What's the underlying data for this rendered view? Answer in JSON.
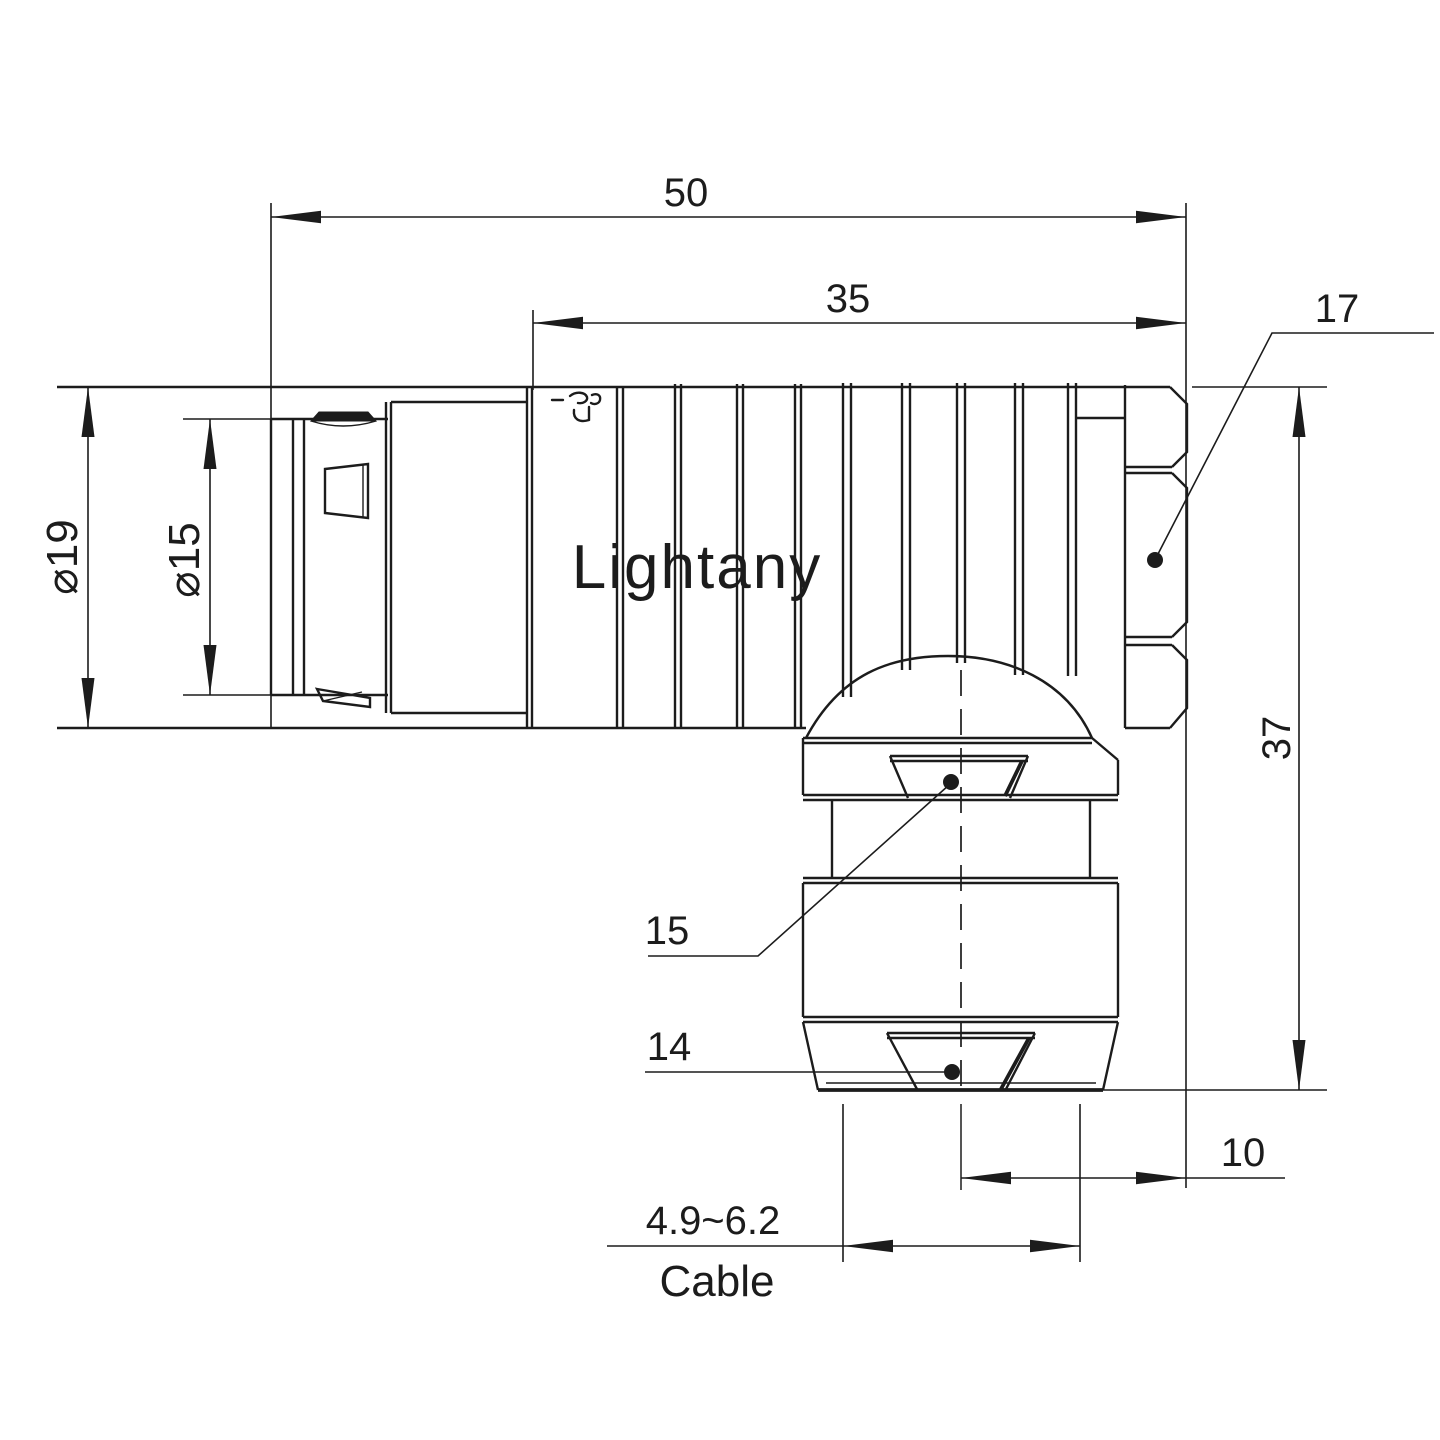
{
  "drawing": {
    "type": "technical-drawing",
    "subject": "right-angle push-pull circular connector, side elevation with section labels",
    "line_color": "#1c1c1c",
    "background_color": "#ffffff"
  },
  "watermark": {
    "text": "Lightany",
    "color": "#f8cbcb"
  },
  "dimensions": {
    "overall_length": {
      "value": "50",
      "orientation": "horizontal"
    },
    "body_length": {
      "value": "35",
      "orientation": "horizontal"
    },
    "hex_nut_label": {
      "value": "17",
      "orientation": "leader"
    },
    "outer_diameter": {
      "value": "⌀19",
      "orientation": "vertical"
    },
    "front_diameter": {
      "value": "⌀15",
      "orientation": "vertical"
    },
    "overall_height": {
      "value": "37",
      "orientation": "vertical"
    },
    "gland_upper_label": {
      "value": "15",
      "orientation": "leader"
    },
    "gland_lower_label": {
      "value": "14",
      "orientation": "leader"
    },
    "axis_to_end": {
      "value": "10",
      "orientation": "horizontal"
    },
    "cable_range": {
      "value": "4.9~6.2",
      "orientation": "horizontal"
    },
    "cable_word": {
      "value": "Cable",
      "orientation": "horizontal"
    }
  }
}
